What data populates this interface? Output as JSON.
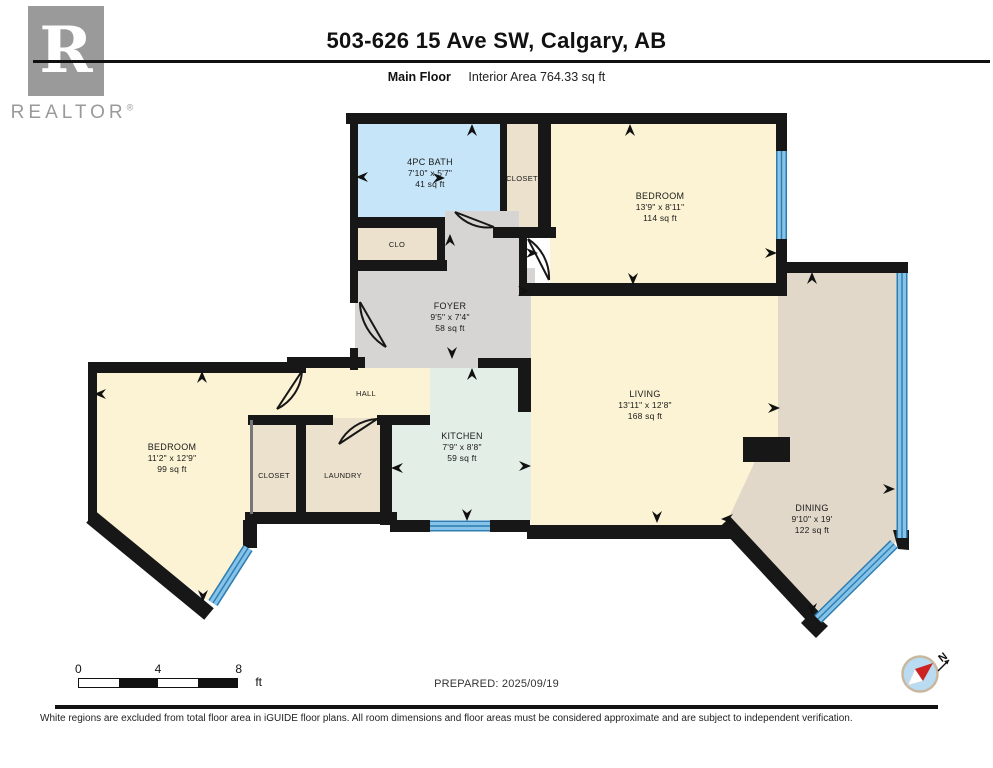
{
  "header": {
    "title": "503-626 15 Ave SW, Calgary, AB",
    "floor_label": "Main Floor",
    "interior_area": "Interior Area 764.33 sq ft"
  },
  "branding": {
    "logo_letter": "R",
    "logo_text": "REALTOR",
    "registered_mark": "®"
  },
  "rooms": {
    "bath": {
      "name": "4PC BATH",
      "dims": "7'10\" x 5'7\"",
      "area": "41 sq ft"
    },
    "closet_top": {
      "name": "CLOSET"
    },
    "bedroom_main": {
      "name": "BEDROOM",
      "dims": "13'9\" x 8'11\"",
      "area": "114 sq ft"
    },
    "clo": {
      "name": "CLO"
    },
    "foyer": {
      "name": "FOYER",
      "dims": "9'5\" x 7'4\"",
      "area": "58 sq ft"
    },
    "hall": {
      "name": "HALL"
    },
    "bedroom_second": {
      "name": "BEDROOM",
      "dims": "11'2\" x 12'9\"",
      "area": "99 sq ft"
    },
    "closet_second": {
      "name": "CLOSET"
    },
    "laundry": {
      "name": "LAUNDRY"
    },
    "kitchen": {
      "name": "KITCHEN",
      "dims": "7'9\" x 8'8\"",
      "area": "59 sq ft"
    },
    "living": {
      "name": "LIVING",
      "dims": "13'11\" x 12'8\"",
      "area": "168 sq ft"
    },
    "dining": {
      "name": "DINING",
      "dims": "9'10\" x 19'",
      "area": "122 sq ft"
    }
  },
  "scale_bar": {
    "labels": [
      "0",
      "4",
      "8"
    ],
    "unit": "ft"
  },
  "compass": {
    "north_label": "N"
  },
  "footer": {
    "prepared": "PREPARED: 2025/09/19",
    "disclaimer": "White regions are excluded from total floor area in iGUIDE floor plans. All room dimensions and floor areas must be considered approximate and are subject to independent verification."
  },
  "colors": {
    "wall": "#171717",
    "window_band": "#85c3e8",
    "window_edge": "#2e7cb0",
    "bath_blue": "#c6e5f8",
    "room_cream": "#fbf3d3",
    "closet_beige": "#ebe1cc",
    "dining_tan": "#e2d8c9",
    "foyer_gray": "#d7d5d3",
    "kitchen_mint": "#e3eee7",
    "compass_red": "#cc2222",
    "logo_gray": "#9a9a9a"
  }
}
